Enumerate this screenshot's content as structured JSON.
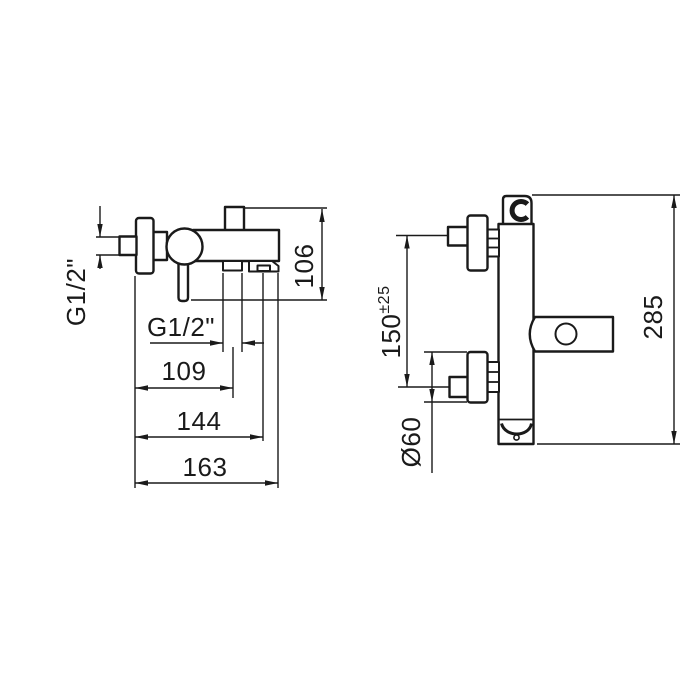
{
  "colors": {
    "background": "#ffffff",
    "line": "#1a1a1a"
  },
  "drawing": {
    "kind": "technical dimension drawing of wall-mounted bath-shower mixer (side and front views)",
    "side_view": {
      "labels": {
        "inlet_thread": "G1/2\"",
        "outlet_thread": "G1/2\"",
        "dim_109": "109",
        "dim_144": "144",
        "dim_163": "163",
        "dim_106": "106"
      }
    },
    "front_view": {
      "labels": {
        "inlet_spacing": "150",
        "inlet_spacing_tolerance": "±25",
        "flange_diameter": "Ø60",
        "dim_285": "285"
      }
    }
  }
}
